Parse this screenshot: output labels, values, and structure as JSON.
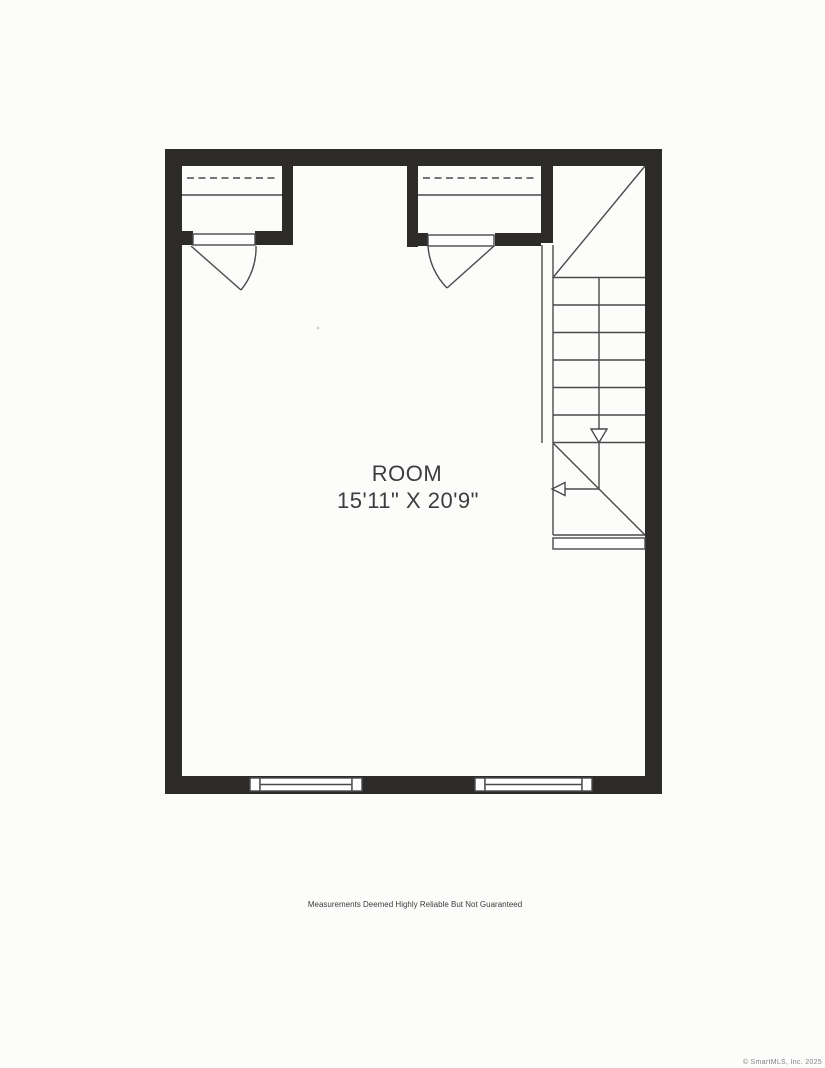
{
  "floor_plan": {
    "room": {
      "name": "ROOM",
      "dimensions": "15'11\" X 20'9\""
    },
    "disclaimer": "Measurements Deemed Highly Reliable But Not Guaranteed",
    "copyright": "© SmartMLS, Inc. 2025",
    "features": {
      "closet_left": "closet with rod and shelf, door swings into room",
      "closet_middle": "closet with rod and shelf, door swings into room",
      "staircase": "stairwell with upper landing, six treads, down direction arrows, lower landing",
      "window_left": "double-hung window in bottom wall",
      "window_right": "double-hung window in bottom wall"
    },
    "colors": {
      "wall": "#2d2b2a",
      "line": "#4a4a4a",
      "text": "#3d3d3d",
      "muted": "#848484",
      "paper": "#fcfcfb"
    }
  }
}
